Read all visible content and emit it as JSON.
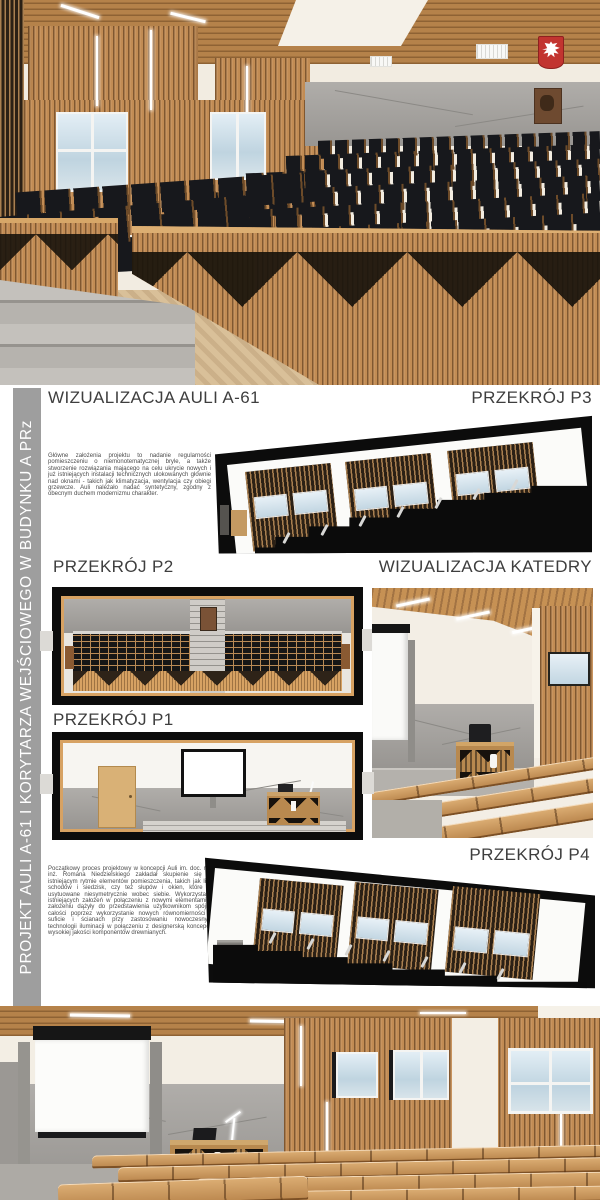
{
  "sidebar": {
    "title": "PROJEKT AULI A-61 I KORYTARZA WEJŚCIOWEGO W BUDYNKU A PRz"
  },
  "labels": {
    "viz_aula": "WIZUALIZACJA AULI A-61",
    "p3": "PRZEKRÓJ P3",
    "p2": "PRZEKRÓJ P2",
    "viz_katedra": "WIZUALIZACJA KATEDRY",
    "p1": "PRZEKRÓJ P1",
    "p4": "PRZEKRÓJ P4"
  },
  "paragraphs": {
    "goals": "Główne założenia projektu to nadanie regularności pomieszczeniu o niemonotematycznej bryle, a także stworzenie rozwiązania mającego na celu ukrycie nowych i już istniejących instalacji technicznych ulokowanych głównie nad oknami - takich jak klimatyzacja, wentylacja czy obiegi grzewcze. Auli należało nadać syntetyczny, zgodny z obecnym duchem modernizmu charakter.",
    "process": "Początkowy proces projektowy w koncepcji Auli im. doc. mgr inż. Romana Niedzielskiego zakładał skupienie się na istniejącym rytmie elementów pomieszczenia, takich jak linia schodów i siedzisk, czy też słupów i okien, które są usytuowane niesymetrycznie wobec siebie. Wykorzystanie istniejących założeń w połączeniu z nowymi elementami w założeniu dążyły do przedstawienia użytkownikom spójnej całości poprzez wykorzystanie nowych równomierności w suficie i ścianach przy zastosowaniu nowoczesnych technologii iluminacji w połączeniu z designerską koncepcją wysokiej jakości komponentów drewnianych."
  },
  "colors": {
    "wood": "#c28c54",
    "wood_dark": "#8a5f33",
    "ceiling_wood": "#b5824a",
    "seat_black": "#17181c",
    "concrete_gray": "#a5a29e",
    "sidebar_gray": "#9e9e9e",
    "label_gray": "#3e3e3e",
    "emblem_red": "#c23430",
    "sky_blue": "#c2d6e2",
    "section_black": "#0c0c0c",
    "parquet": "#d9c099"
  }
}
